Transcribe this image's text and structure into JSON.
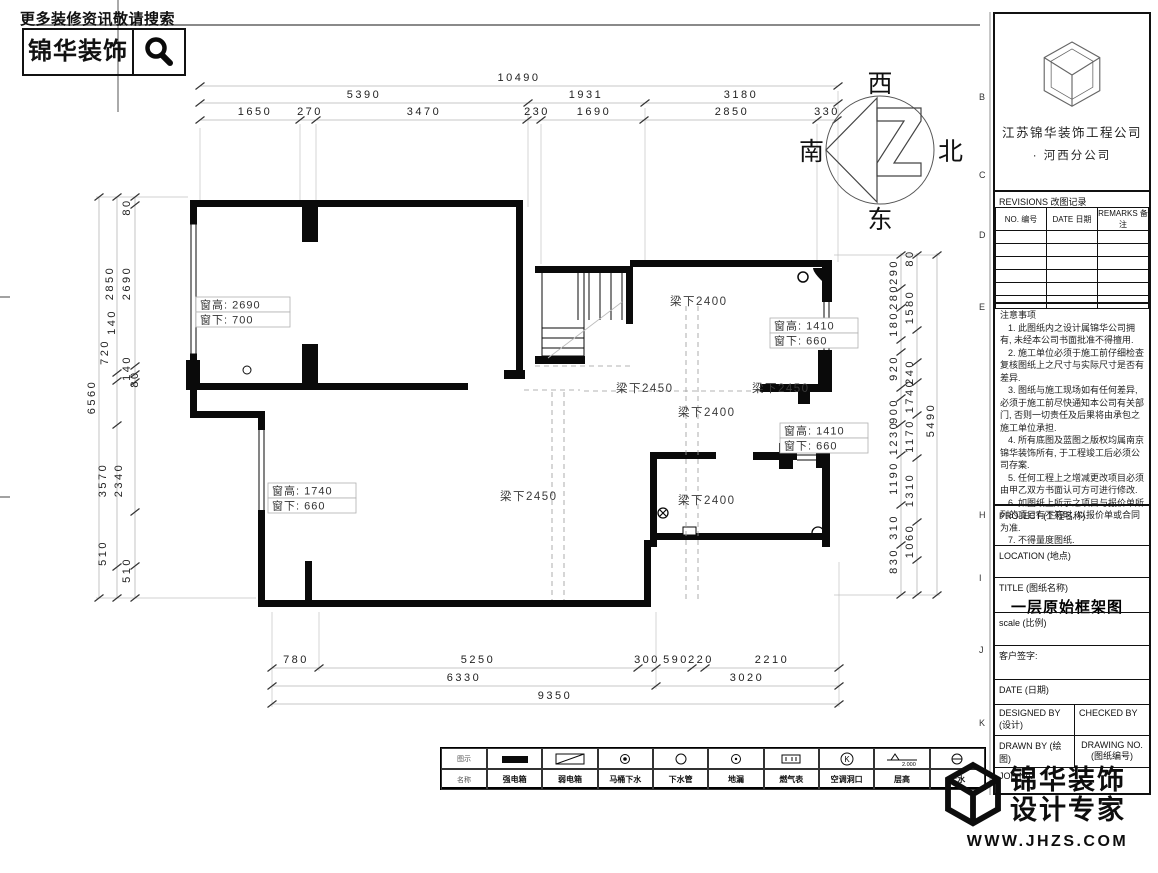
{
  "promo": {
    "tagline": "更多装修资讯敬请搜索",
    "brand": "锦华装饰"
  },
  "compass": {
    "top": "西",
    "right": "北",
    "left": "南",
    "bottom": "东"
  },
  "plan": {
    "dims_top": [
      "10490",
      "5390",
      "1931",
      "3180",
      "1650",
      "270",
      "3470",
      "230",
      "1690",
      "2850",
      "330"
    ],
    "dims_bottom": [
      "780",
      "5250",
      "300",
      "590",
      "220",
      "2210",
      "6330",
      "3020",
      "9350"
    ],
    "dims_left": [
      "6560",
      "3570",
      "2850",
      "2690",
      "80",
      "140",
      "720",
      "140",
      "80",
      "2340",
      "510",
      "510"
    ],
    "dims_right": [
      "5490",
      "80",
      "290",
      "280",
      "1580",
      "180",
      "920",
      "240",
      "1740",
      "900",
      "1230",
      "1170",
      "1190",
      "1310",
      "310",
      "1060",
      "830"
    ],
    "window_labels": [
      {
        "line1": "窗高: 2690",
        "line2": "窗下: 700"
      },
      {
        "line1": "窗高: 1410",
        "line2": "窗下: 660"
      },
      {
        "line1": "窗高: 1410",
        "line2": "窗下: 660"
      },
      {
        "line1": "窗高: 1740",
        "line2": "窗下: 660"
      }
    ],
    "beam_labels": [
      "梁下2400",
      "梁下2450",
      "梁下2450",
      "梁下2400",
      "梁下2450",
      "梁下2400"
    ]
  },
  "grid_letters": [
    "B",
    "C",
    "D",
    "E",
    "H",
    "I",
    "J",
    "K"
  ],
  "titleblock": {
    "company_line1": "江苏锦华装饰工程公司",
    "company_line2": "·  河西分公司",
    "revisions_title": "REVISIONS 改图记录",
    "rev_cols": [
      "NO. 编号",
      "DATE 日期",
      "REMARKS 备注"
    ],
    "notes_title": "注意事项",
    "notes": [
      "1. 此图纸内之设计属锦华公司拥有, 未经本公司书面批准不得擅用.",
      "2. 施工单位必须于施工前仔细检查复核图纸上之尺寸与实际尺寸是否有差异.",
      "3. 图纸与施工现场如有任何差异, 必须于施工前尽快通知本公司有关部门, 否则一切责任及后果将由承包之施工单位承担.",
      "4. 所有底图及蓝图之版权均属南京锦华装饰所有, 于工程竣工后必须公司存案.",
      "5. 任何工程上之增减更改项目必须由甲乙双方书面认可方可进行修改.",
      "6. 如图纸上所示之项目与报价单所列的项目有不符时, 以报价单或合同为准.",
      "7. 不得量度图纸."
    ],
    "project_label": "PROJECT (工程名称)",
    "location_label": "LOCATION (地点)",
    "title_label": "TITLE (图纸名称)",
    "drawing_title": "一层原始框架图",
    "scale_label": "scale  (比例)",
    "client_sign_label": "客户签字:",
    "date_label": "DATE (日期)",
    "designed_label": "DESIGNED BY (设计)",
    "checked_label": "CHECKED BY",
    "drawn_label": "DRAWN BY (绘图)",
    "drawing_no_label1": "DRAWING NO.",
    "drawing_no_label2": "(图纸编号)",
    "job_label": "JOB No."
  },
  "legend": {
    "col_label_symbol": "图示",
    "col_label_name": "名称",
    "level_value": "2.000",
    "items": [
      {
        "name": "强电箱"
      },
      {
        "name": "弱电箱"
      },
      {
        "name": "马桶下水"
      },
      {
        "name": "下水管"
      },
      {
        "name": "地漏"
      },
      {
        "name": "燃气表"
      },
      {
        "name": "空调洞口"
      },
      {
        "name": "层高"
      },
      {
        "name": "上水"
      }
    ]
  },
  "watermark": {
    "line1": "锦华装饰",
    "line2": "设计专家",
    "url": "WWW.JHZS.COM"
  }
}
